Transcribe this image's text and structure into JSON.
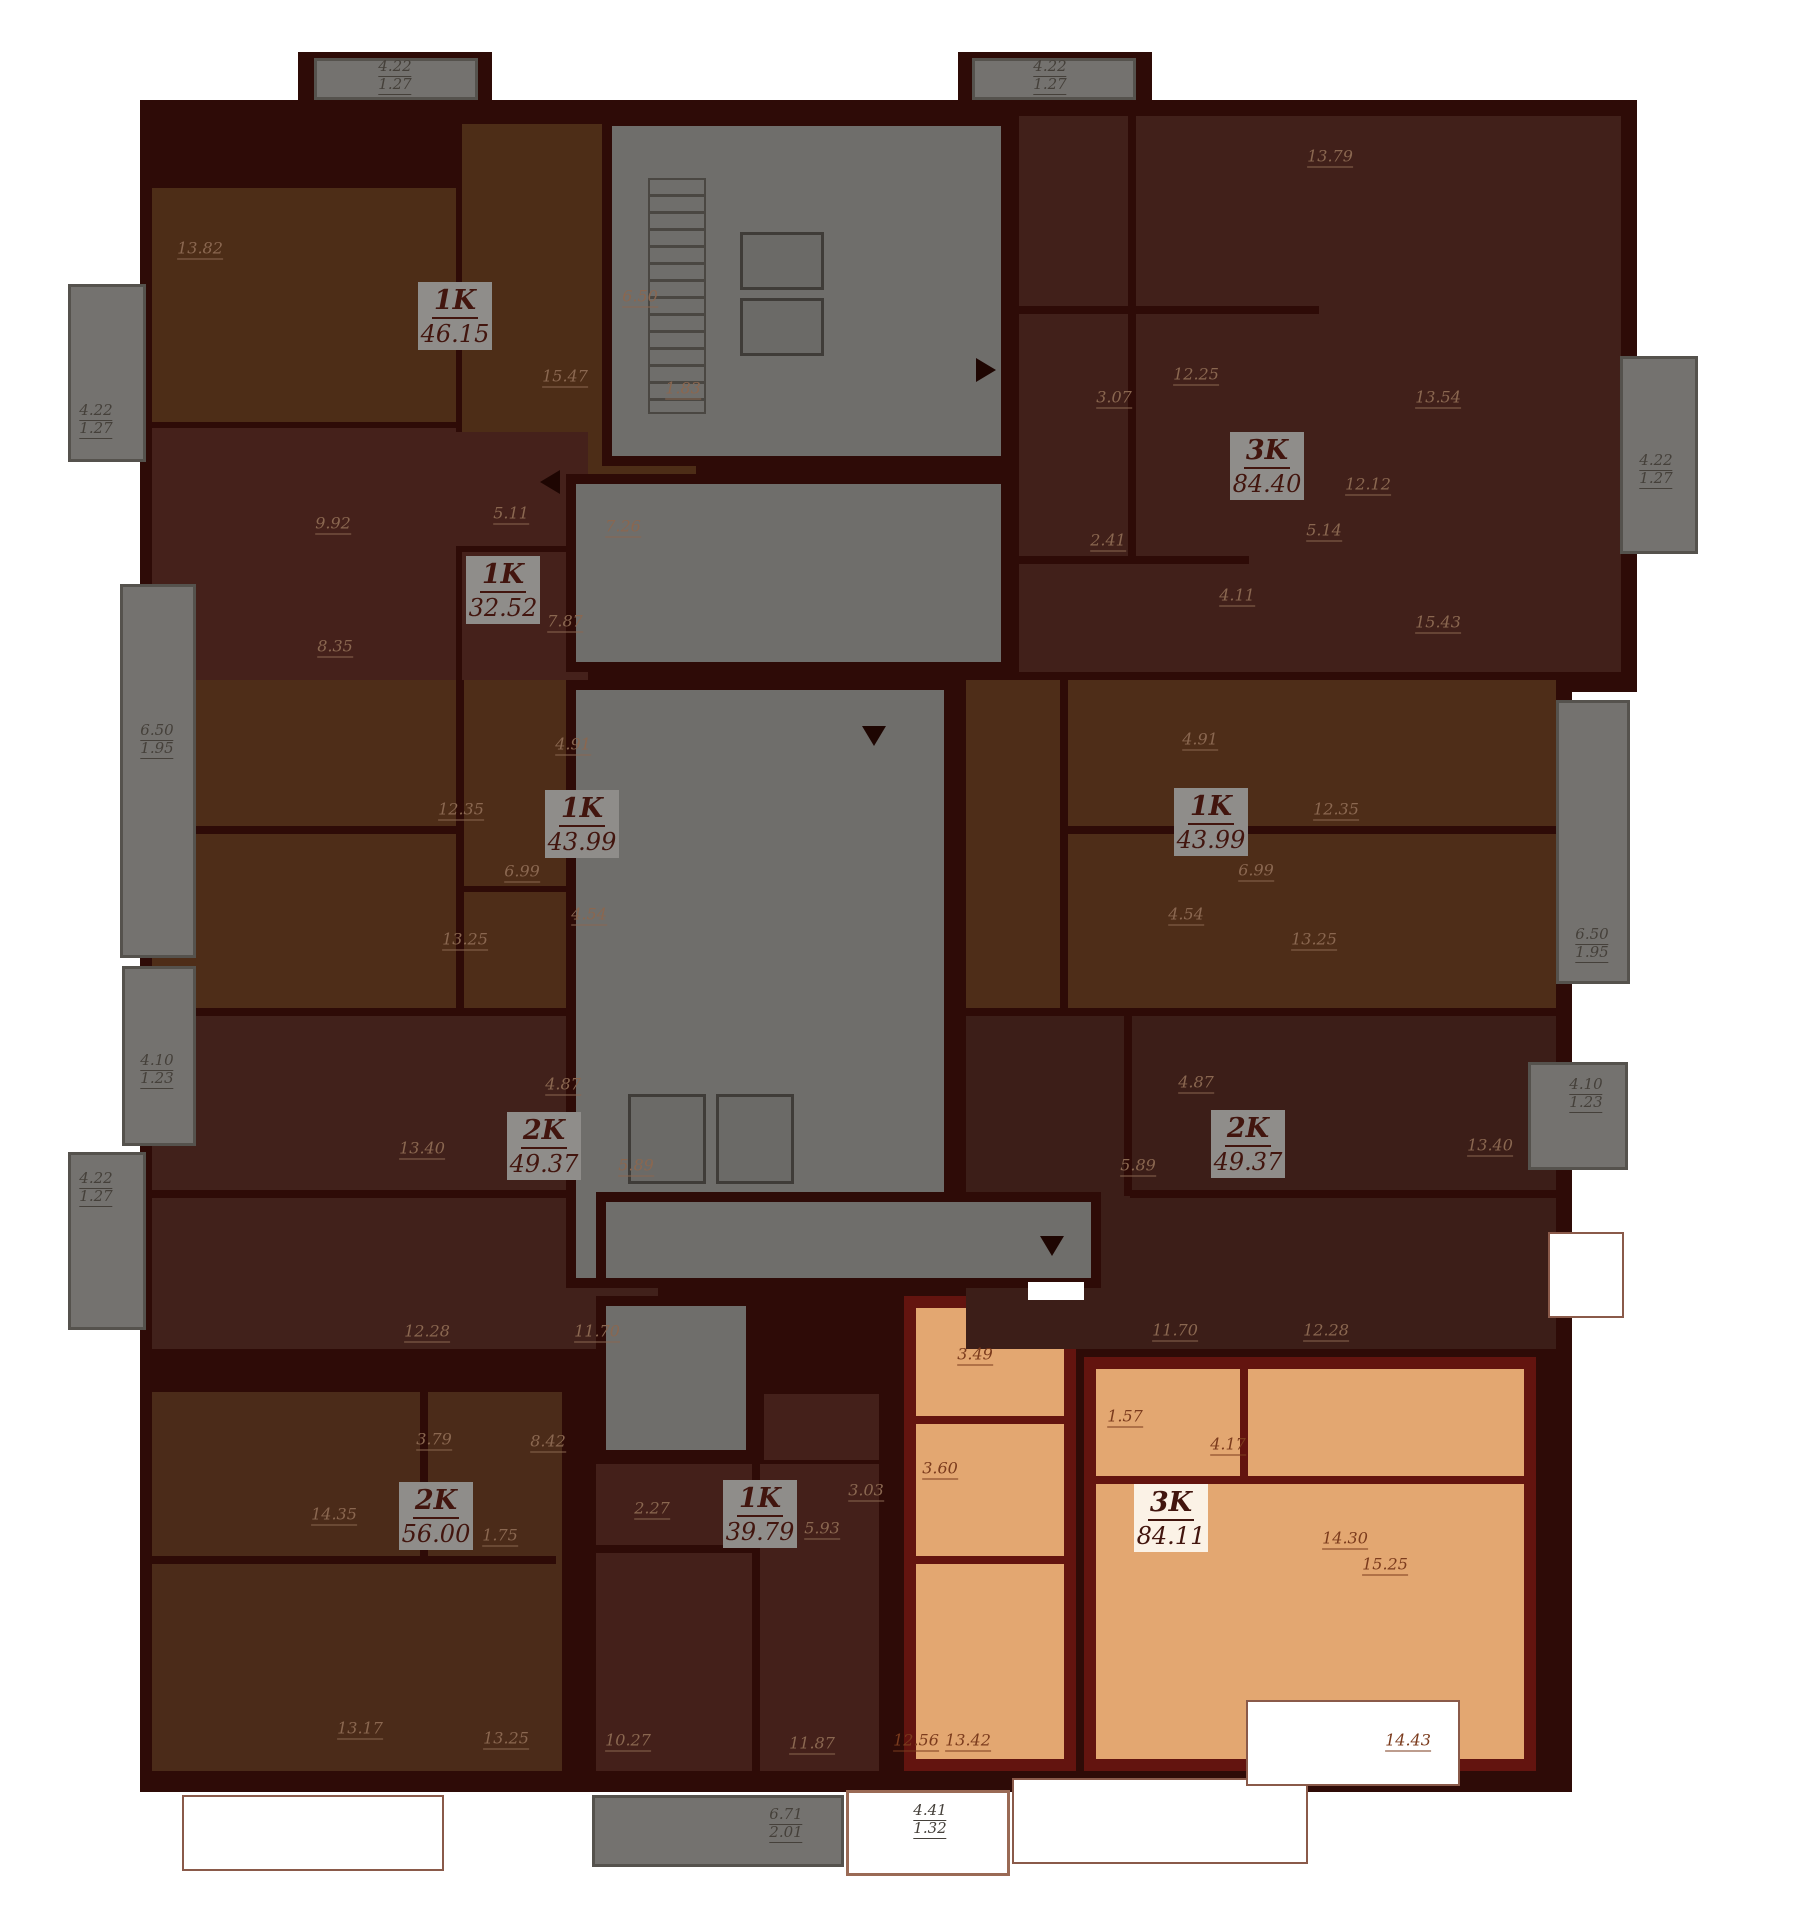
{
  "canvas": {
    "width": 1793,
    "height": 1920,
    "background": "#ffffff"
  },
  "colors": {
    "wall": "#2e0b07",
    "selected_wall": "#63140f",
    "core_gray": "#6f6e6b",
    "balcony_gray": "#74726f",
    "label_box": "#8f8d8a",
    "label_box_selected": "#fbf2e6",
    "label_text": "#42150e",
    "dim_dark": "#8a6750",
    "dim_orange": "#7b3b1d",
    "dim_gray": "#45403a",
    "selected_fill": "#e3a771"
  },
  "base": {
    "rects": [
      [
        140,
        100,
        1497,
        592
      ],
      [
        140,
        692,
        1432,
        1100
      ],
      [
        298,
        52,
        194,
        52
      ],
      [
        958,
        52,
        194,
        52
      ]
    ]
  },
  "core": {
    "label": "stair-and-elevator-core",
    "rects": [
      [
        602,
        116,
        409,
        350
      ],
      [
        566,
        474,
        445,
        198
      ],
      [
        566,
        680,
        388,
        608
      ],
      [
        596,
        1192,
        505,
        96
      ],
      [
        596,
        1296,
        160,
        164
      ]
    ],
    "stairs": [
      648,
      178,
      58,
      236
    ],
    "lifts": [
      [
        740,
        232,
        84,
        58
      ],
      [
        740,
        298,
        84,
        58
      ],
      [
        628,
        1094,
        78,
        90
      ],
      [
        716,
        1094,
        78,
        90
      ]
    ]
  },
  "gaps": [
    [
      1028,
      1282,
      56,
      18
    ]
  ],
  "arrows": [
    {
      "dir": "down",
      "x": 862,
      "y": 726
    },
    {
      "dir": "right",
      "x": 976,
      "y": 358
    },
    {
      "dir": "left",
      "x": 540,
      "y": 470
    },
    {
      "dir": "down",
      "x": 1040,
      "y": 1236
    }
  ],
  "inner_walls": [
    [
      152,
      826,
      310,
      8
    ],
    [
      456,
      680,
      8,
      332
    ],
    [
      460,
      886,
      200,
      6
    ],
    [
      152,
      1190,
      440,
      8
    ],
    [
      584,
      1016,
      8,
      180
    ],
    [
      152,
      1556,
      404,
      8
    ],
    [
      420,
      1392,
      8,
      168
    ],
    [
      752,
      1464,
      8,
      307
    ],
    [
      596,
      1545,
      160,
      8
    ],
    [
      1128,
      116,
      8,
      440
    ],
    [
      1019,
      306,
      300,
      8
    ],
    [
      1019,
      556,
      230,
      8
    ],
    [
      1060,
      826,
      496,
      8
    ],
    [
      1060,
      680,
      8,
      332
    ],
    [
      1130,
      1190,
      426,
      8
    ],
    [
      1124,
      1016,
      8,
      180
    ]
  ],
  "selected_inner_walls": [
    [
      904,
      1416,
      172,
      8
    ],
    [
      904,
      1556,
      172,
      8
    ],
    [
      1240,
      1357,
      8,
      120
    ],
    [
      1084,
      1476,
      452,
      8
    ]
  ],
  "apartments": [
    {
      "id": "1k-46-15",
      "type": "1K",
      "area": "46.15",
      "color": "#4d2d17",
      "selected": false,
      "rects": [
        [
          152,
          188,
          304,
          234
        ],
        [
          462,
          124,
          234,
          422
        ]
      ],
      "label_box": [
        418,
        282,
        74,
        68
      ],
      "rooms": [
        {
          "t": "13.82",
          "x": 200,
          "y": 250
        },
        {
          "t": "15.47",
          "x": 565,
          "y": 378
        },
        {
          "t": "6.50",
          "x": 640,
          "y": 298
        },
        {
          "t": "1.83",
          "x": 683,
          "y": 390
        },
        {
          "t": "7.26",
          "x": 623,
          "y": 528
        }
      ]
    },
    {
      "id": "1k-32-52",
      "type": "1K",
      "area": "32.52",
      "color": "#45211b",
      "selected": false,
      "rects": [
        [
          152,
          428,
          304,
          266
        ],
        [
          432,
          432,
          156,
          114
        ],
        [
          462,
          552,
          126,
          142
        ]
      ],
      "label_box": [
        466,
        556,
        74,
        68
      ],
      "rooms": [
        {
          "t": "9.92",
          "x": 333,
          "y": 525
        },
        {
          "t": "8.35",
          "x": 335,
          "y": 648
        },
        {
          "t": "5.11",
          "x": 511,
          "y": 515
        },
        {
          "t": "7.87",
          "x": 565,
          "y": 623
        }
      ]
    },
    {
      "id": "1k-43-99-left",
      "type": "1K",
      "area": "43.99",
      "color": "#4e2d18",
      "selected": false,
      "rects": [
        [
          152,
          680,
          506,
          328
        ]
      ],
      "label_box": [
        545,
        790,
        74,
        68
      ],
      "rooms": [
        {
          "t": "12.35",
          "x": 461,
          "y": 811
        },
        {
          "t": "13.25",
          "x": 465,
          "y": 941
        },
        {
          "t": "4.91",
          "x": 573,
          "y": 746
        },
        {
          "t": "6.99",
          "x": 522,
          "y": 873
        },
        {
          "t": "4.54",
          "x": 589,
          "y": 916
        }
      ]
    },
    {
      "id": "2k-49-37-left",
      "type": "2K",
      "area": "49.37",
      "color": "#41211b",
      "selected": false,
      "rects": [
        [
          152,
          1016,
          506,
          333
        ]
      ],
      "label_box": [
        507,
        1112,
        74,
        68
      ],
      "rooms": [
        {
          "t": "13.40",
          "x": 422,
          "y": 1150
        },
        {
          "t": "4.87",
          "x": 563,
          "y": 1086
        },
        {
          "t": "5.89",
          "x": 636,
          "y": 1167
        },
        {
          "t": "12.28",
          "x": 427,
          "y": 1333
        },
        {
          "t": "11.70",
          "x": 597,
          "y": 1333
        }
      ]
    },
    {
      "id": "2k-56-00",
      "type": "2K",
      "area": "56.00",
      "color": "#4b2b19",
      "selected": false,
      "rects": [
        [
          152,
          1392,
          410,
          379
        ]
      ],
      "label_box": [
        399,
        1482,
        74,
        68
      ],
      "rooms": [
        {
          "t": "14.35",
          "x": 334,
          "y": 1516
        },
        {
          "t": "3.79",
          "x": 434,
          "y": 1441
        },
        {
          "t": "8.42",
          "x": 548,
          "y": 1443
        },
        {
          "t": "1.75",
          "x": 500,
          "y": 1537
        },
        {
          "t": "13.17",
          "x": 360,
          "y": 1730
        },
        {
          "t": "13.25",
          "x": 506,
          "y": 1740
        }
      ]
    },
    {
      "id": "1k-39-79",
      "type": "1K",
      "area": "39.79",
      "color": "#44201a",
      "selected": false,
      "rects": [
        [
          596,
          1464,
          283,
          307
        ],
        [
          764,
          1394,
          115,
          66
        ]
      ],
      "label_box": [
        723,
        1480,
        74,
        68
      ],
      "rooms": [
        {
          "t": "2.27",
          "x": 652,
          "y": 1510
        },
        {
          "t": "3.03",
          "x": 866,
          "y": 1492
        },
        {
          "t": "5.93",
          "x": 822,
          "y": 1530
        },
        {
          "t": "10.27",
          "x": 628,
          "y": 1742
        },
        {
          "t": "11.87",
          "x": 812,
          "y": 1745
        }
      ]
    },
    {
      "id": "3k-84-11",
      "type": "3K",
      "area": "84.11",
      "color": "#e3a771",
      "selected": true,
      "rects": [
        [
          904,
          1296,
          172,
          475
        ],
        [
          1084,
          1357,
          452,
          414
        ]
      ],
      "label_box": [
        1134,
        1484,
        74,
        68
      ],
      "rooms": [
        {
          "t": "3.49",
          "x": 975,
          "y": 1356
        },
        {
          "t": "1.57",
          "x": 1125,
          "y": 1418
        },
        {
          "t": "4.17",
          "x": 1228,
          "y": 1446
        },
        {
          "t": "3.60",
          "x": 940,
          "y": 1470
        },
        {
          "t": "12.56",
          "x": 916,
          "y": 1742
        },
        {
          "t": "13.42",
          "x": 968,
          "y": 1742
        },
        {
          "t": "14.30",
          "x": 1345,
          "y": 1540
        },
        {
          "t": "15.25",
          "x": 1385,
          "y": 1566
        },
        {
          "t": "14.43",
          "x": 1408,
          "y": 1742
        }
      ]
    },
    {
      "id": "3k-84-40",
      "type": "3K",
      "area": "84.40",
      "color": "#41201a",
      "selected": false,
      "rects": [
        [
          1019,
          116,
          602,
          556
        ]
      ],
      "label_box": [
        1230,
        432,
        74,
        68
      ],
      "rooms": [
        {
          "t": "13.79",
          "x": 1330,
          "y": 158
        },
        {
          "t": "12.25",
          "x": 1196,
          "y": 376
        },
        {
          "t": "3.07",
          "x": 1114,
          "y": 399
        },
        {
          "t": "2.41",
          "x": 1108,
          "y": 542
        },
        {
          "t": "5.14",
          "x": 1324,
          "y": 532
        },
        {
          "t": "4.11",
          "x": 1237,
          "y": 597
        },
        {
          "t": "12.12",
          "x": 1368,
          "y": 486
        },
        {
          "t": "15.43",
          "x": 1438,
          "y": 624
        },
        {
          "t": "13.54",
          "x": 1438,
          "y": 399
        }
      ]
    },
    {
      "id": "1k-43-99-right",
      "type": "1K",
      "area": "43.99",
      "color": "#4e2d18",
      "selected": false,
      "rects": [
        [
          966,
          680,
          590,
          328
        ]
      ],
      "label_box": [
        1174,
        788,
        74,
        68
      ],
      "rooms": [
        {
          "t": "4.91",
          "x": 1200,
          "y": 741
        },
        {
          "t": "12.35",
          "x": 1336,
          "y": 811
        },
        {
          "t": "6.99",
          "x": 1256,
          "y": 872
        },
        {
          "t": "4.54",
          "x": 1186,
          "y": 916
        },
        {
          "t": "13.25",
          "x": 1314,
          "y": 941
        }
      ]
    },
    {
      "id": "2k-49-37-right",
      "type": "2K",
      "area": "49.37",
      "color": "#3c1e18",
      "selected": false,
      "rects": [
        [
          966,
          1016,
          590,
          333
        ]
      ],
      "label_box": [
        1211,
        1110,
        74,
        68
      ],
      "rooms": [
        {
          "t": "4.87",
          "x": 1196,
          "y": 1084
        },
        {
          "t": "5.89",
          "x": 1138,
          "y": 1167
        },
        {
          "t": "13.40",
          "x": 1490,
          "y": 1147
        },
        {
          "t": "11.70",
          "x": 1175,
          "y": 1332
        },
        {
          "t": "12.28",
          "x": 1326,
          "y": 1332
        }
      ]
    }
  ],
  "balconies": [
    {
      "style": "gray",
      "rect": [
        314,
        58,
        164,
        42
      ],
      "labels": [
        {
          "t": "4.22",
          "x": 395,
          "y": 68
        },
        {
          "t": "1.27",
          "x": 395,
          "y": 86
        }
      ]
    },
    {
      "style": "gray",
      "rect": [
        972,
        58,
        164,
        42
      ],
      "labels": [
        {
          "t": "4.22",
          "x": 1050,
          "y": 68
        },
        {
          "t": "1.27",
          "x": 1050,
          "y": 86
        }
      ]
    },
    {
      "style": "gray",
      "rect": [
        68,
        284,
        78,
        178
      ],
      "labels": [
        {
          "t": "4.22",
          "x": 96,
          "y": 412
        },
        {
          "t": "1.27",
          "x": 96,
          "y": 430
        }
      ]
    },
    {
      "style": "gray",
      "rect": [
        120,
        584,
        76,
        374
      ],
      "labels": [
        {
          "t": "6.50",
          "x": 157,
          "y": 732
        },
        {
          "t": "1.95",
          "x": 157,
          "y": 750
        }
      ]
    },
    {
      "style": "gray",
      "rect": [
        122,
        966,
        74,
        180
      ],
      "labels": [
        {
          "t": "4.10",
          "x": 157,
          "y": 1062
        },
        {
          "t": "1.23",
          "x": 157,
          "y": 1080
        }
      ]
    },
    {
      "style": "gray",
      "rect": [
        68,
        1152,
        78,
        178
      ],
      "labels": [
        {
          "t": "4.22",
          "x": 96,
          "y": 1180
        },
        {
          "t": "1.27",
          "x": 96,
          "y": 1198
        }
      ]
    },
    {
      "style": "gray",
      "rect": [
        1620,
        356,
        78,
        198
      ],
      "labels": [
        {
          "t": "4.22",
          "x": 1656,
          "y": 462
        },
        {
          "t": "1.27",
          "x": 1656,
          "y": 480
        }
      ]
    },
    {
      "style": "gray",
      "rect": [
        1556,
        700,
        74,
        284
      ],
      "labels": [
        {
          "t": "6.50",
          "x": 1592,
          "y": 936
        },
        {
          "t": "1.95",
          "x": 1592,
          "y": 954
        }
      ]
    },
    {
      "style": "gray",
      "rect": [
        1528,
        1062,
        100,
        108
      ],
      "labels": [
        {
          "t": "4.10",
          "x": 1586,
          "y": 1086
        },
        {
          "t": "1.23",
          "x": 1586,
          "y": 1104
        }
      ]
    },
    {
      "style": "gray",
      "rect": [
        592,
        1795,
        252,
        72
      ],
      "labels": [
        {
          "t": "6.71",
          "x": 786,
          "y": 1816
        },
        {
          "t": "2.01",
          "x": 786,
          "y": 1834
        }
      ]
    },
    {
      "style": "white",
      "rect": [
        846,
        1790,
        164,
        86
      ],
      "labels": [
        {
          "t": "4.41",
          "x": 930,
          "y": 1812
        },
        {
          "t": "1.32",
          "x": 930,
          "y": 1830
        }
      ]
    },
    {
      "style": "outline",
      "rect": [
        1012,
        1778,
        296,
        86
      ],
      "labels": []
    },
    {
      "style": "outline",
      "rect": [
        1548,
        1232,
        76,
        86
      ],
      "labels": []
    },
    {
      "style": "outline",
      "rect": [
        182,
        1795,
        262,
        76
      ],
      "labels": []
    },
    {
      "style": "outline",
      "rect": [
        1246,
        1700,
        214,
        86
      ],
      "labels": []
    }
  ]
}
